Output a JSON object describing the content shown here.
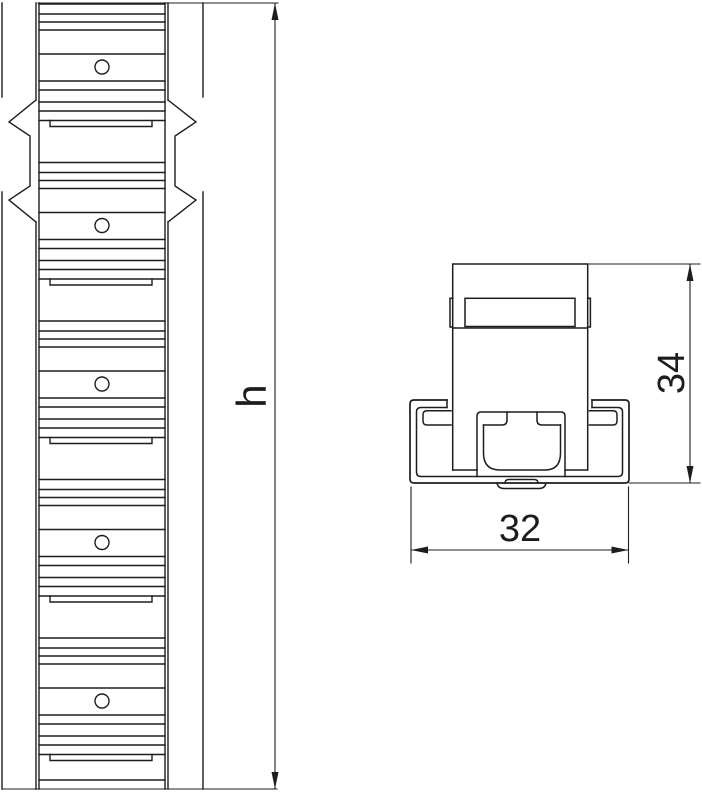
{
  "drawing": {
    "colors": {
      "line": "#1d1d1b",
      "background": "#ffffff"
    },
    "labels": {
      "rail_height": "h",
      "section_height": "34",
      "section_width": "32"
    },
    "front_view": {
      "pattern": {
        "x1": 39,
        "x2": 165,
        "clip_top": 3,
        "clip_bottom": 788,
        "slot_tops": [
          -38,
          120.5,
          279,
          437.5,
          596,
          754.5
        ],
        "line_offsets": [
          42,
          52,
          60,
          68,
          92,
          119,
          128,
          140,
          149
        ],
        "lip": {
          "x1": 50,
          "x2": 152,
          "depth": 6
        },
        "hole": {
          "cx": 102,
          "offset": 105,
          "r": 7
        },
        "hole_count": 5
      }
    },
    "dimensions": [
      {
        "name": "rail-height",
        "label": "h",
        "orientation": "vertical"
      },
      {
        "name": "section-height",
        "label": "34",
        "orientation": "vertical"
      },
      {
        "name": "section-width",
        "label": "32",
        "orientation": "horizontal"
      }
    ]
  }
}
